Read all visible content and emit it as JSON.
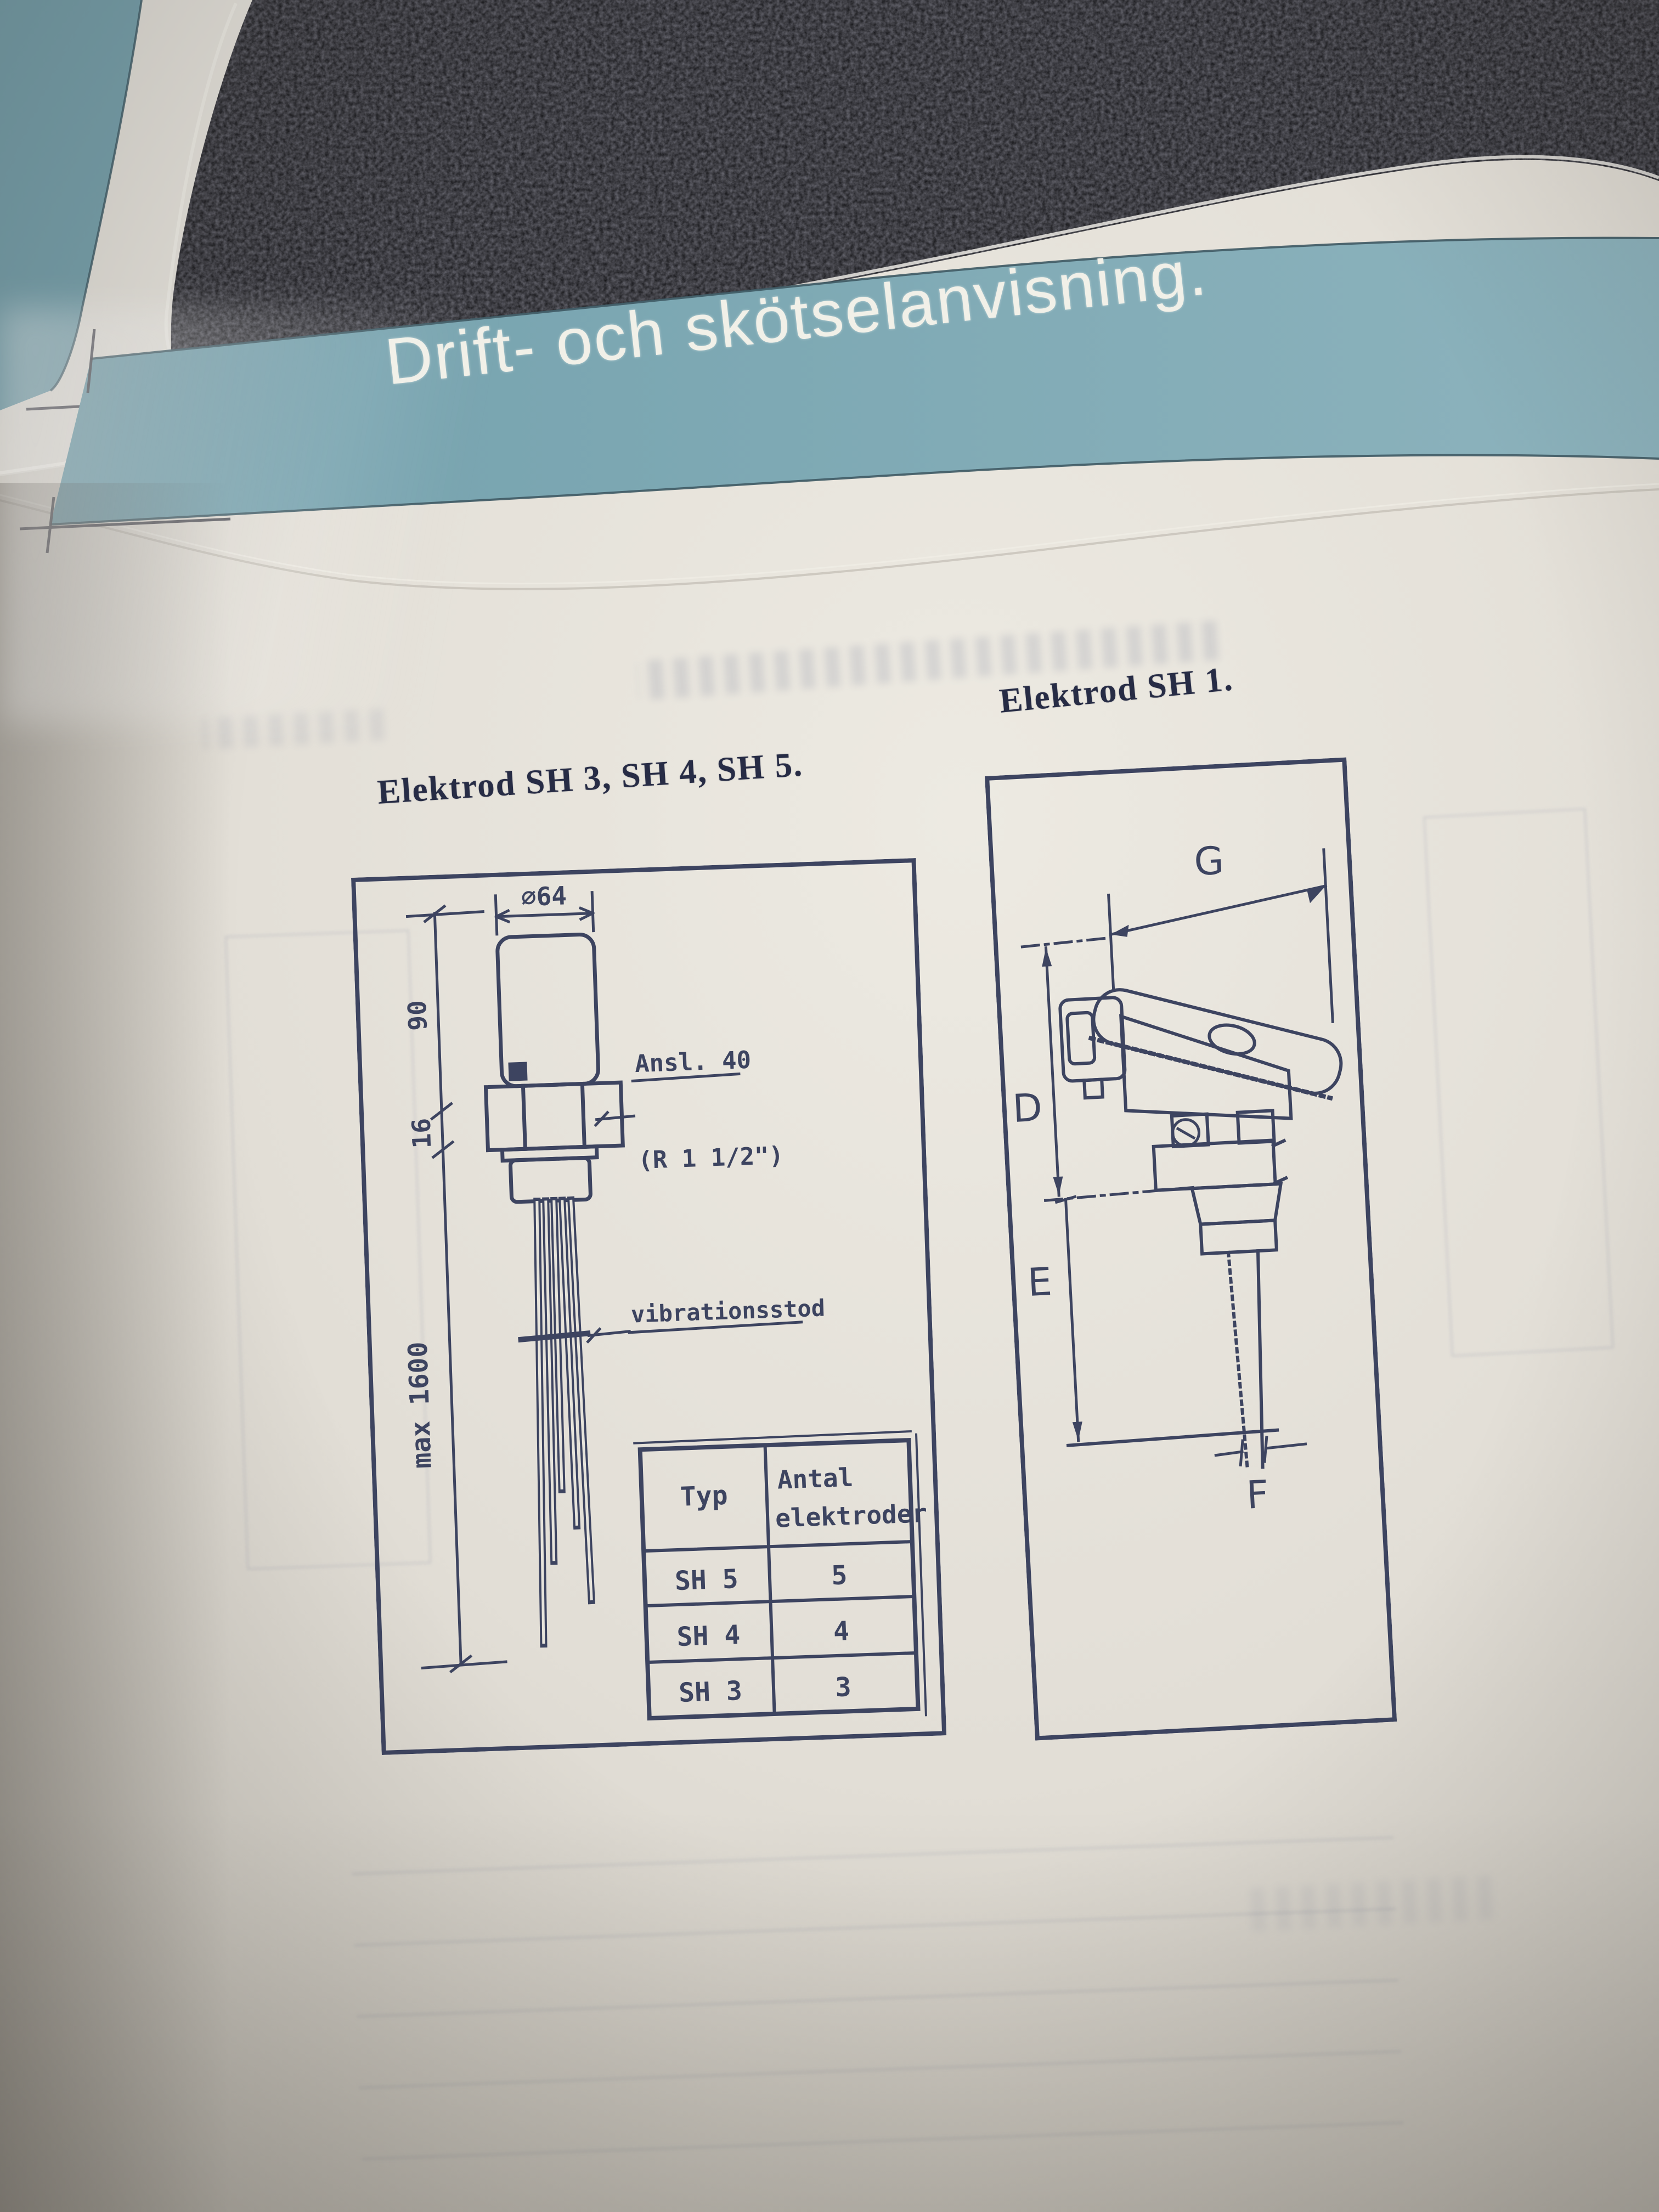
{
  "banner": {
    "title": "Drift- och skötselanvisning."
  },
  "left_diagram": {
    "title": "Elektrod  SH 3, SH 4, SH 5.",
    "labels": {
      "diameter": "∅64",
      "height_90": "90",
      "height_16": "16",
      "max_length": "max 1600",
      "connection_line1": "Ansl. 40",
      "connection_line2": "(R 1 1/2\")",
      "vibration_support": "vibrationsstod"
    },
    "table": {
      "headers": [
        {
          "lines": [
            "Typ"
          ]
        },
        {
          "lines": [
            "Antal",
            "elektroder"
          ]
        }
      ],
      "rows": [
        {
          "typ": "SH 5",
          "antal": "5"
        },
        {
          "typ": "SH 4",
          "antal": "4"
        },
        {
          "typ": "SH 3",
          "antal": "3"
        }
      ]
    }
  },
  "right_diagram": {
    "title": "Elektrod SH 1.",
    "labels": {
      "width_g": "G",
      "height_d": "D",
      "height_e": "E",
      "width_f": "F"
    }
  },
  "colors": {
    "banner_teal": "#7ea9b4",
    "ink": "#3d4460",
    "paper": "#e7e4dc",
    "carpet": "#17171b",
    "banner_text": "#f1f0e8"
  }
}
